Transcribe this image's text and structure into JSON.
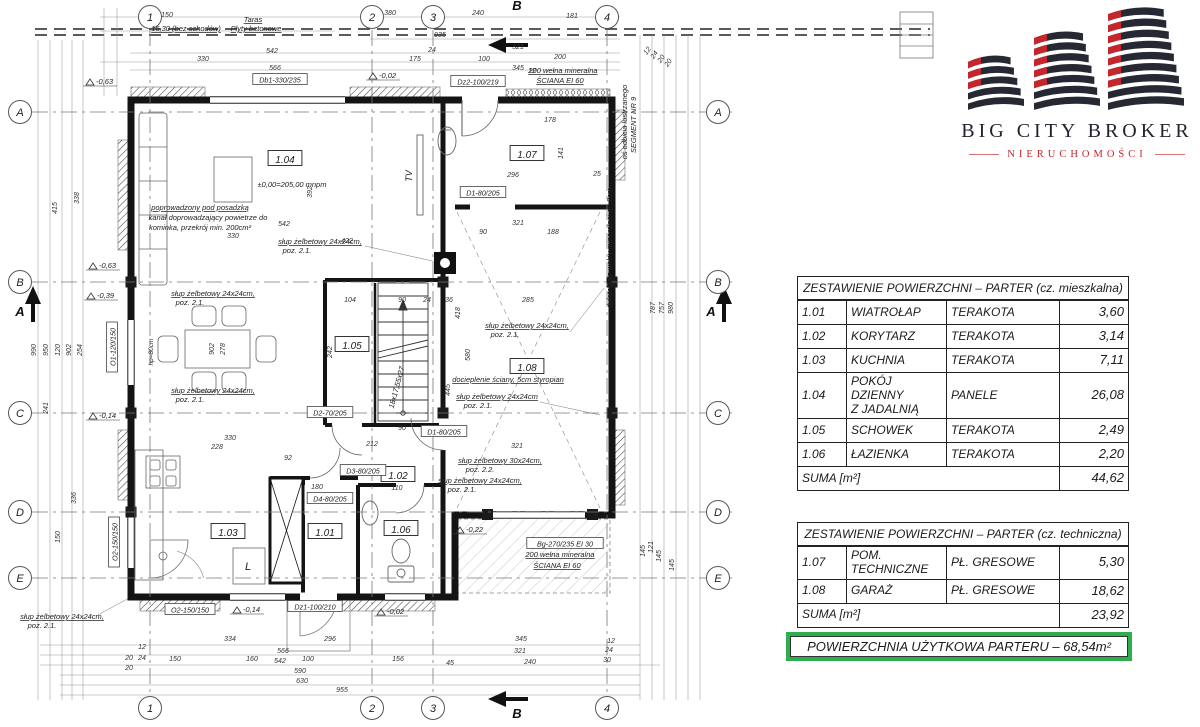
{
  "logo": {
    "title": "BIG CITY BROKER",
    "subtitle": "NIERUCHOMOŚCI",
    "colors": {
      "dark": "#262833",
      "red": "#c4262b"
    }
  },
  "tables": {
    "residential": {
      "title": "ZESTAWIENIE POWIERZCHNI – PARTER (cz. mieszkalna)",
      "rows": [
        {
          "code": "1.01",
          "name": "WIATROŁAP",
          "finish": "TERAKOTA",
          "area": "3,60"
        },
        {
          "code": "1.02",
          "name": "KORYTARZ",
          "finish": "TERAKOTA",
          "area": "3,14"
        },
        {
          "code": "1.03",
          "name": "KUCHNIA",
          "finish": "TERAKOTA",
          "area": "7,11"
        },
        {
          "code": "1.04",
          "name": "POKÓJ DZIENNY\nZ JADALNIĄ",
          "finish": "PANELE",
          "area": "26,08"
        },
        {
          "code": "1.05",
          "name": "SCHOWEK",
          "finish": "TERAKOTA",
          "area": "2,49"
        },
        {
          "code": "1.06",
          "name": "ŁAZIENKA",
          "finish": "TERAKOTA",
          "area": "2,20"
        }
      ],
      "sum_label": "SUMA [m²]",
      "sum": "44,62"
    },
    "technical": {
      "title": "ZESTAWIENIE POWIERZCHNI – PARTER (cz. techniczna)",
      "rows": [
        {
          "code": "1.07",
          "name": "POM.\nTECHNICZNE",
          "finish": "PŁ. GRESOWE",
          "area": "5,30"
        },
        {
          "code": "1.08",
          "name": "GARAŻ",
          "finish": "PŁ. GRESOWE",
          "area": "18,62"
        }
      ],
      "sum_label": "SUMA [m²]",
      "sum": "23,92"
    },
    "total": {
      "label": "POWIERZCHNIA UŻYTKOWA PARTERU – 68,54m²",
      "border_color": "#2fae4e"
    }
  },
  "plan": {
    "grid": {
      "cols": [
        {
          "label": "1",
          "x": 150
        },
        {
          "label": "2",
          "x": 372
        },
        {
          "label": "3",
          "x": 433
        },
        {
          "label": "4",
          "x": 607
        }
      ],
      "rows": [
        {
          "label": "A",
          "y": 112
        },
        {
          "label": "B",
          "y": 282
        },
        {
          "label": "C",
          "y": 413
        },
        {
          "label": "D",
          "y": 512
        },
        {
          "label": "E",
          "y": 578
        }
      ]
    },
    "sections": [
      {
        "label": "B",
        "x": 517,
        "y": 10
      },
      {
        "label": "B",
        "x": 517,
        "y": 718
      },
      {
        "label": "A",
        "x": 20,
        "y": 316
      },
      {
        "label": "A",
        "x": 711,
        "y": 316
      }
    ],
    "room_labels": [
      {
        "t": "1.04",
        "x": 285,
        "y": 161
      },
      {
        "t": "1.07",
        "x": 527,
        "y": 156
      },
      {
        "t": "1.05",
        "x": 352,
        "y": 347
      },
      {
        "t": "1.08",
        "x": 527,
        "y": 369
      },
      {
        "t": "1.02",
        "x": 398,
        "y": 477
      },
      {
        "t": "1.01",
        "x": 325,
        "y": 534
      },
      {
        "t": "1.03",
        "x": 228,
        "y": 534
      },
      {
        "t": "1.06",
        "x": 401,
        "y": 531
      }
    ],
    "opening_labels": [
      {
        "t": "Db1-330/235",
        "x": 280,
        "y": 81
      },
      {
        "t": "Dz2-100/219",
        "x": 478,
        "y": 83
      },
      {
        "t": "O1-120/150",
        "x": 114,
        "y": 347,
        "r": -90
      },
      {
        "t": "O2-150/150",
        "x": 116,
        "y": 542,
        "r": -90
      },
      {
        "t": "O2-150/150",
        "x": 190,
        "y": 611
      },
      {
        "t": "Dz1-100/210",
        "x": 315,
        "y": 608
      },
      {
        "t": "D1-80/205",
        "x": 483,
        "y": 194
      },
      {
        "t": "D1-80/205",
        "x": 444,
        "y": 433
      },
      {
        "t": "D2-70/205",
        "x": 330,
        "y": 414
      },
      {
        "t": "D3-80/205",
        "x": 363,
        "y": 472
      },
      {
        "t": "D4-80/205",
        "x": 330,
        "y": 500
      },
      {
        "t": "Bg-270/235 EI 30",
        "x": 565,
        "y": 545
      }
    ],
    "annotations": [
      {
        "t": "Taras",
        "x": 253,
        "y": 22,
        "u": 1
      },
      {
        "t": "15,30 (bez schodów)",
        "x": 186,
        "y": 31,
        "u": 1
      },
      {
        "t": "Płyty betonowe",
        "x": 256,
        "y": 31,
        "u": 1
      },
      {
        "t": "±0,00=205,00 mnpm",
        "x": 292,
        "y": 187
      },
      {
        "t": "poprowadzony pod posadzką",
        "x": 200,
        "y": 210,
        "u": 1
      },
      {
        "t": "kanał doprowadzający powietrze do",
        "x": 208,
        "y": 220
      },
      {
        "t": "kominka, przekrój min. 200cm²",
        "x": 200,
        "y": 230
      },
      {
        "t": "słup żelbetowy 24x24cm,",
        "x": 320,
        "y": 244,
        "u": 1
      },
      {
        "t": "poz. 2.1.",
        "x": 297,
        "y": 253
      },
      {
        "t": "słup żelbetowy 24x24cm,",
        "x": 213,
        "y": 296,
        "u": 1
      },
      {
        "t": "poz. 2.1.",
        "x": 190,
        "y": 305
      },
      {
        "t": "słup żelbetowy 24x24cm,",
        "x": 213,
        "y": 393,
        "u": 1
      },
      {
        "t": "poz. 2.1.",
        "x": 190,
        "y": 402
      },
      {
        "t": "słup żelbetowy 24x24cm,",
        "x": 527,
        "y": 328,
        "u": 1
      },
      {
        "t": "poz. 2.1.",
        "x": 505,
        "y": 337
      },
      {
        "t": "słup żelbetowy 24x24cm",
        "x": 497,
        "y": 399,
        "u": 1
      },
      {
        "t": "poz. 2.1.",
        "x": 478,
        "y": 408
      },
      {
        "t": "słup żelbetowy 30x24cm,",
        "x": 500,
        "y": 463,
        "u": 1
      },
      {
        "t": "poz. 2.2.",
        "x": 480,
        "y": 472
      },
      {
        "t": "słup żelbetowy 24x24cm,",
        "x": 480,
        "y": 483,
        "u": 1
      },
      {
        "t": "poz. 2.1.",
        "x": 462,
        "y": 492
      },
      {
        "t": "słup żelbetowy 24x24cm,",
        "x": 62,
        "y": 619,
        "u": 1
      },
      {
        "t": "poz. 2.1.",
        "x": 42,
        "y": 628
      },
      {
        "t": "docieplenie ściany, 5cm styropian",
        "x": 508,
        "y": 382,
        "u": 1
      },
      {
        "t": "200  wełna mineralna",
        "x": 563,
        "y": 73,
        "u": 1
      },
      {
        "t": "ŚCIANA EI 60",
        "x": 560,
        "y": 83,
        "u": 1
      },
      {
        "t": "200  wełna mineralna",
        "x": 560,
        "y": 557,
        "u": 1
      },
      {
        "t": "ŚCIANA EI 60",
        "x": 557,
        "y": 568,
        "u": 1
      },
      {
        "t": "dylatacja z wełny mineralnej gr. 2cm",
        "x": 612,
        "y": 248,
        "r": -90
      },
      {
        "t": "oś odbicia lustrzanego",
        "x": 627,
        "y": 122,
        "r": -90
      },
      {
        "t": "SEGMENT NR 9",
        "x": 636,
        "y": 125,
        "r": -90
      },
      {
        "t": "TV",
        "x": 412,
        "y": 176,
        "r": -90,
        "s": 9
      },
      {
        "t": "L",
        "x": 248,
        "y": 570,
        "s": 11
      },
      {
        "t": "hp=80cm",
        "x": 153,
        "y": 352,
        "r": -90,
        "s": 6.5
      },
      {
        "t": "18x17,55x27",
        "x": 399,
        "y": 388,
        "r": -75
      }
    ],
    "elevation_marks": [
      {
        "t": "-0,63",
        "x": 95,
        "y": 84
      },
      {
        "t": "-0,02",
        "x": 378,
        "y": 78
      },
      {
        "t": "-0,63",
        "x": 98,
        "y": 268
      },
      {
        "t": "-0,39",
        "x": 96,
        "y": 298
      },
      {
        "t": "-0,14",
        "x": 98,
        "y": 418
      },
      {
        "t": "-0,14",
        "x": 242,
        "y": 612
      },
      {
        "t": "-0,02",
        "x": 386,
        "y": 614
      },
      {
        "t": "-0,22",
        "x": 465,
        "y": 532
      }
    ],
    "dimensions": [
      {
        "t": "150",
        "x": 167,
        "y": 17
      },
      {
        "t": "380",
        "x": 390,
        "y": 15
      },
      {
        "t": "240",
        "x": 478,
        "y": 15
      },
      {
        "t": "181",
        "x": 572,
        "y": 18
      },
      {
        "t": "935",
        "x": 440,
        "y": 37
      },
      {
        "t": "321",
        "x": 518,
        "y": 49
      },
      {
        "t": "24",
        "x": 432,
        "y": 52
      },
      {
        "t": "542",
        "x": 272,
        "y": 53
      },
      {
        "t": "330",
        "x": 203,
        "y": 61
      },
      {
        "t": "175",
        "x": 415,
        "y": 61
      },
      {
        "t": "100",
        "x": 484,
        "y": 61
      },
      {
        "t": "200",
        "x": 560,
        "y": 59
      },
      {
        "t": "566",
        "x": 275,
        "y": 70
      },
      {
        "t": "345",
        "x": 518,
        "y": 70
      },
      {
        "t": "12",
        "x": 532,
        "y": 73
      },
      {
        "t": "178",
        "x": 550,
        "y": 122
      },
      {
        "t": "296",
        "x": 513,
        "y": 177
      },
      {
        "t": "25",
        "x": 597,
        "y": 176
      },
      {
        "t": "141",
        "x": 563,
        "y": 153,
        "r": -90
      },
      {
        "t": "542",
        "x": 284,
        "y": 226
      },
      {
        "t": "330",
        "x": 233,
        "y": 238
      },
      {
        "t": "422",
        "x": 347,
        "y": 243
      },
      {
        "t": "392",
        "x": 312,
        "y": 192,
        "r": -90
      },
      {
        "t": "90",
        "x": 483,
        "y": 234
      },
      {
        "t": "188",
        "x": 553,
        "y": 234
      },
      {
        "t": "321",
        "x": 518,
        "y": 225
      },
      {
        "t": "104",
        "x": 350,
        "y": 302
      },
      {
        "t": "90",
        "x": 402,
        "y": 302
      },
      {
        "t": "24",
        "x": 427,
        "y": 302
      },
      {
        "t": "36",
        "x": 449,
        "y": 302
      },
      {
        "t": "285",
        "x": 528,
        "y": 302
      },
      {
        "t": "242",
        "x": 332,
        "y": 352,
        "r": -90
      },
      {
        "t": "580",
        "x": 470,
        "y": 355,
        "r": -90
      },
      {
        "t": "445",
        "x": 450,
        "y": 390,
        "r": -90
      },
      {
        "t": "418",
        "x": 460,
        "y": 313,
        "r": -90
      },
      {
        "t": "902",
        "x": 214,
        "y": 349,
        "r": -90
      },
      {
        "t": "278",
        "x": 225,
        "y": 349,
        "r": -90
      },
      {
        "t": "212",
        "x": 372,
        "y": 446
      },
      {
        "t": "90",
        "x": 402,
        "y": 430
      },
      {
        "t": "110",
        "x": 397,
        "y": 490
      },
      {
        "t": "92",
        "x": 288,
        "y": 460
      },
      {
        "t": "180",
        "x": 317,
        "y": 489
      },
      {
        "t": "330",
        "x": 230,
        "y": 440
      },
      {
        "t": "228",
        "x": 217,
        "y": 449
      },
      {
        "t": "321",
        "x": 517,
        "y": 448
      },
      {
        "t": "990",
        "x": 36,
        "y": 350,
        "r": -90
      },
      {
        "t": "950",
        "x": 48,
        "y": 350,
        "r": -90
      },
      {
        "t": "120",
        "x": 60,
        "y": 350,
        "r": -90
      },
      {
        "t": "902",
        "x": 71,
        "y": 350,
        "r": -90
      },
      {
        "t": "254",
        "x": 82,
        "y": 350,
        "r": -90
      },
      {
        "t": "415",
        "x": 57,
        "y": 208,
        "r": -90
      },
      {
        "t": "338",
        "x": 79,
        "y": 198,
        "r": -90
      },
      {
        "t": "241",
        "x": 48,
        "y": 408,
        "r": -90
      },
      {
        "t": "150",
        "x": 60,
        "y": 537,
        "r": -90
      },
      {
        "t": "336",
        "x": 76,
        "y": 498,
        "r": -90
      },
      {
        "t": "787",
        "x": 655,
        "y": 308,
        "r": -90
      },
      {
        "t": "757",
        "x": 664,
        "y": 308,
        "r": -90
      },
      {
        "t": "980",
        "x": 673,
        "y": 308,
        "r": -90
      },
      {
        "t": "145",
        "x": 645,
        "y": 551,
        "r": -90
      },
      {
        "t": "121",
        "x": 653,
        "y": 547,
        "r": -90
      },
      {
        "t": "145",
        "x": 661,
        "y": 556,
        "r": -90
      },
      {
        "t": "145",
        "x": 674,
        "y": 565,
        "r": -90
      },
      {
        "t": "12",
        "x": 649,
        "y": 52,
        "r": -55
      },
      {
        "t": "24",
        "x": 656,
        "y": 56,
        "r": -55
      },
      {
        "t": "20",
        "x": 663,
        "y": 60,
        "r": -55
      },
      {
        "t": "20",
        "x": 670,
        "y": 64,
        "r": -55
      },
      {
        "t": "334",
        "x": 230,
        "y": 641
      },
      {
        "t": "296",
        "x": 330,
        "y": 641
      },
      {
        "t": "345",
        "x": 521,
        "y": 641
      },
      {
        "t": "566",
        "x": 283,
        "y": 653
      },
      {
        "t": "321",
        "x": 520,
        "y": 653
      },
      {
        "t": "542",
        "x": 280,
        "y": 663
      },
      {
        "t": "240",
        "x": 530,
        "y": 664
      },
      {
        "t": "150",
        "x": 175,
        "y": 661
      },
      {
        "t": "160",
        "x": 252,
        "y": 661
      },
      {
        "t": "100",
        "x": 308,
        "y": 661
      },
      {
        "t": "156",
        "x": 398,
        "y": 661
      },
      {
        "t": "45",
        "x": 450,
        "y": 665
      },
      {
        "t": "590",
        "x": 300,
        "y": 673
      },
      {
        "t": "630",
        "x": 302,
        "y": 683
      },
      {
        "t": "955",
        "x": 342,
        "y": 692
      },
      {
        "t": "12",
        "x": 611,
        "y": 643
      },
      {
        "t": "24",
        "x": 609,
        "y": 652
      },
      {
        "t": "30",
        "x": 607,
        "y": 662
      },
      {
        "t": "12",
        "x": 142,
        "y": 649
      },
      {
        "t": "24",
        "x": 142,
        "y": 660
      },
      {
        "t": "20",
        "x": 129,
        "y": 660
      },
      {
        "t": "20",
        "x": 129,
        "y": 670
      }
    ]
  }
}
